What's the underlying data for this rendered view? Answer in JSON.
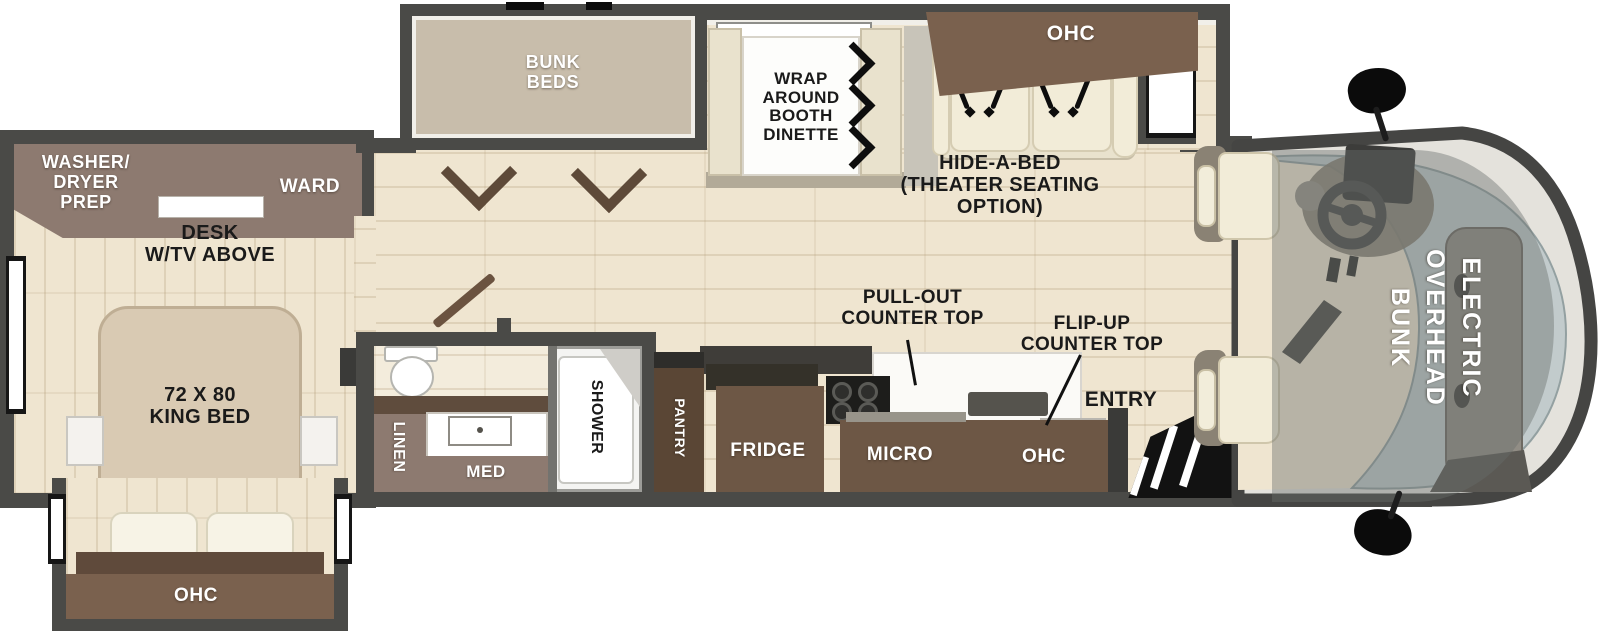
{
  "title": "Motorhome floor plan",
  "labels": {
    "bunk_beds": "BUNK\nBEDS",
    "wrap_dinette": "WRAP\nAROUND\nBOOTH\nDINETTE",
    "sofa_ohc": "OHC",
    "hide_a_bed": "HIDE-A-BED\n(THEATER SEATING\nOPTION)",
    "washer_dryer": "WASHER/\nDRYER\nPREP",
    "ward": "WARD",
    "desk": "DESK\nW/TV ABOVE",
    "king_bed": "72 X 80\nKING BED",
    "bed_ohc": "OHC",
    "linen": "LINEN",
    "med": "MED",
    "shower": "SHOWER",
    "pantry": "PANTRY",
    "fridge": "FRIDGE",
    "micro": "MICRO",
    "kitchen_ohc": "OHC",
    "pull_out_counter": "PULL-OUT\nCOUNTER TOP",
    "flip_up_counter": "FLIP-UP\nCOUNTER TOP",
    "entry": "ENTRY",
    "overhead_bunk": "ELECTRIC\nOVERHEAD\nBUNK"
  },
  "colors": {
    "wall": "#4a4a47",
    "floor": "#efe5d0",
    "floor_light": "#f3ecdc",
    "slide_floor": "#c8bdab",
    "cabinet": "#6d5745",
    "cabinet_rich": "#7a614e",
    "mauve": "#8d7a70",
    "mauve_dark": "#5f4c3d",
    "pantry": "#5a4635",
    "bed": "#d9cab3",
    "bed_edge": "#bfae94",
    "cream": "#e9e2cd",
    "cushion": "#f2ecd8",
    "headboard": "#5f4a3b",
    "wood_door": "#6b5340",
    "windshield": "#c2cbcc",
    "cap_rim": "#e4e2dc",
    "mech": "#918d85",
    "dash": "#867f72",
    "black": "#1a1a1a",
    "booth_base": "#b2aa98",
    "divider": "#c8c4b9",
    "lining": "#f1efe9",
    "overlay": "rgba(104,109,107,0.42)"
  }
}
